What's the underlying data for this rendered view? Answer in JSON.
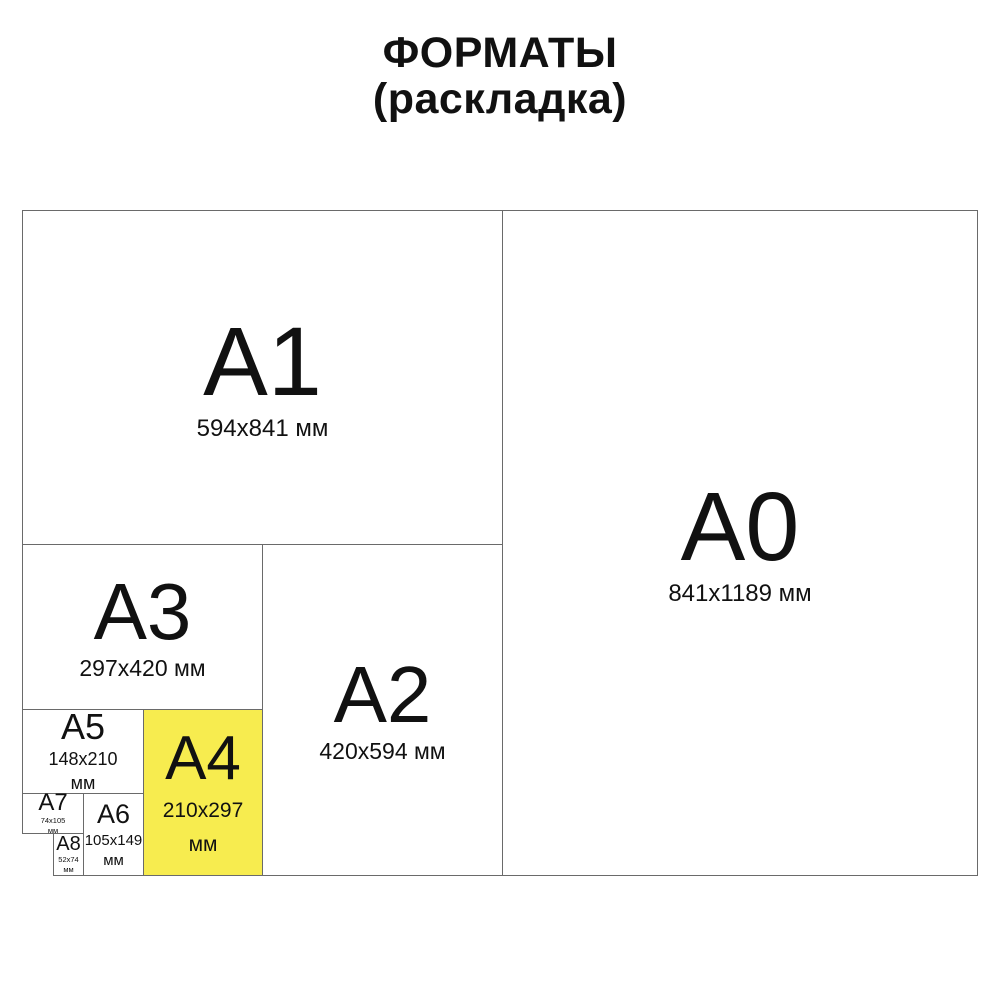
{
  "title": {
    "line1": "ФОРМАТЫ",
    "line2": "(раскладка)"
  },
  "colors": {
    "background": "#ffffff",
    "border": "#6a6a6a",
    "text": "#111111",
    "highlight_fill": "#f7ec4f"
  },
  "formats": {
    "a0": {
      "name": "A0",
      "size": "841x1189 мм"
    },
    "a1": {
      "name": "A1",
      "size": "594x841 мм"
    },
    "a2": {
      "name": "A2",
      "size": "420x594 мм"
    },
    "a3": {
      "name": "A3",
      "size": "297x420 мм"
    },
    "a4": {
      "name": "A4",
      "size": "210x297",
      "unit": "мм",
      "highlighted": true
    },
    "a5": {
      "name": "A5",
      "size": "148x210",
      "unit": "мм"
    },
    "a6": {
      "name": "A6",
      "size": "105x149",
      "unit": "мм"
    },
    "a7": {
      "name": "A7",
      "size": "74x105",
      "unit": "мм"
    },
    "a8": {
      "name": "A8",
      "size": "52x74",
      "unit": "мм"
    }
  }
}
